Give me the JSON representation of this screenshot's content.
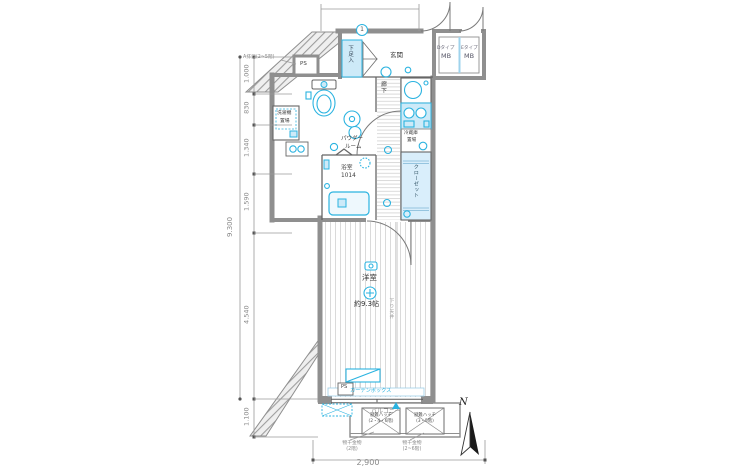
{
  "colors": {
    "accent": "#2bb3e0",
    "accent_fill": "#cdeaf8",
    "wall": "#8f8f8f",
    "dim_text": "#8a8a8a"
  },
  "dims": {
    "total": "9.300",
    "segments": [
      "1.000",
      "830",
      "1.340",
      "1.590",
      "4.540",
      "1.100"
    ],
    "width": "2,900"
  },
  "labels": {
    "entrance": "玄関",
    "shoe": "下足入",
    "mb_d_type": "Dタイプ",
    "mb_d": "MB",
    "mb_e_type": "Eタイプ",
    "mb_e": "MB",
    "ps_top": "PS",
    "ps_bottom": "PS",
    "washer_l1": "洗濯機",
    "washer_l2": "置場",
    "powder_l1": "パウダー",
    "powder_l2": "ルーム",
    "bath": "浴室",
    "bath_size": "1014",
    "corridor": "廊下",
    "fridge_l1": "冷蔵庫",
    "fridge_l2": "置場",
    "closet": "クローゼット",
    "room": "洋室",
    "room_size": "約9.3帖",
    "dropped_ceiling": "下り天井",
    "curtain_box": "カーテンボックス",
    "balcony": "バルコニー",
    "hatch_left_l1": "避難ハッチ",
    "hatch_left_l2": "(2・4・6階)",
    "hatch_right_l1": "避難ハッチ",
    "hatch_right_l2": "(3・5階)",
    "fitting_left_l1": "物干金物",
    "fitting_left_l2": "(2階)",
    "fitting_right_l1": "物干金物",
    "fitting_right_l2": "(2~6階)",
    "vent": "A排口(2~5階)",
    "unit_no": "1",
    "north": "N"
  }
}
